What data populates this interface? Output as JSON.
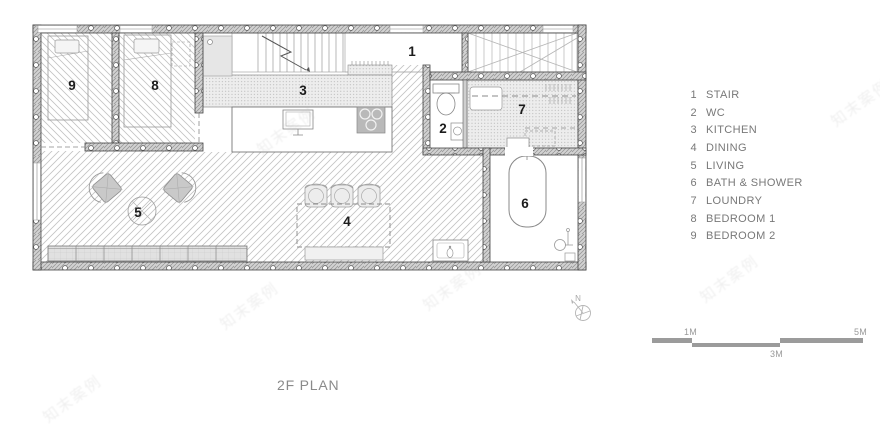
{
  "page": {
    "title_text": "2F PLAN"
  },
  "legend": {
    "items": [
      {
        "number": "1",
        "label": "STAIR"
      },
      {
        "number": "2",
        "label": "WC"
      },
      {
        "number": "3",
        "label": "KITCHEN"
      },
      {
        "number": "4",
        "label": "DINING"
      },
      {
        "number": "5",
        "label": "LIVING"
      },
      {
        "number": "6",
        "label": "BATH & SHOWER"
      },
      {
        "number": "7",
        "label": "LOUNDRY"
      },
      {
        "number": "8",
        "label": "BEDROOM 1"
      },
      {
        "number": "9",
        "label": "BEDROOM 2"
      }
    ]
  },
  "plan": {
    "rooms": [
      {
        "number": "1",
        "name": "stair"
      },
      {
        "number": "2",
        "name": "wc"
      },
      {
        "number": "3",
        "name": "kitchen"
      },
      {
        "number": "4",
        "name": "dining"
      },
      {
        "number": "5",
        "name": "living"
      },
      {
        "number": "6",
        "name": "bath-shower"
      },
      {
        "number": "7",
        "name": "loundry"
      },
      {
        "number": "8",
        "name": "bedroom-1"
      },
      {
        "number": "9",
        "name": "bedroom-2"
      }
    ]
  },
  "scale_bar": {
    "label_1m": "1M",
    "label_3m": "3M",
    "label_5m": "5M"
  },
  "compass": {
    "label": "N"
  },
  "watermark": {
    "text": "知末案例"
  },
  "colors": {
    "wall_fill": "#d2d2d2",
    "wall_line": "#444444",
    "floor_hatch": "#c3c3c3",
    "stipple_bg": "#ededed",
    "room_label": "#1c1c1c",
    "legend_text": "#787878",
    "scale_bar": "#9b9b9b"
  }
}
